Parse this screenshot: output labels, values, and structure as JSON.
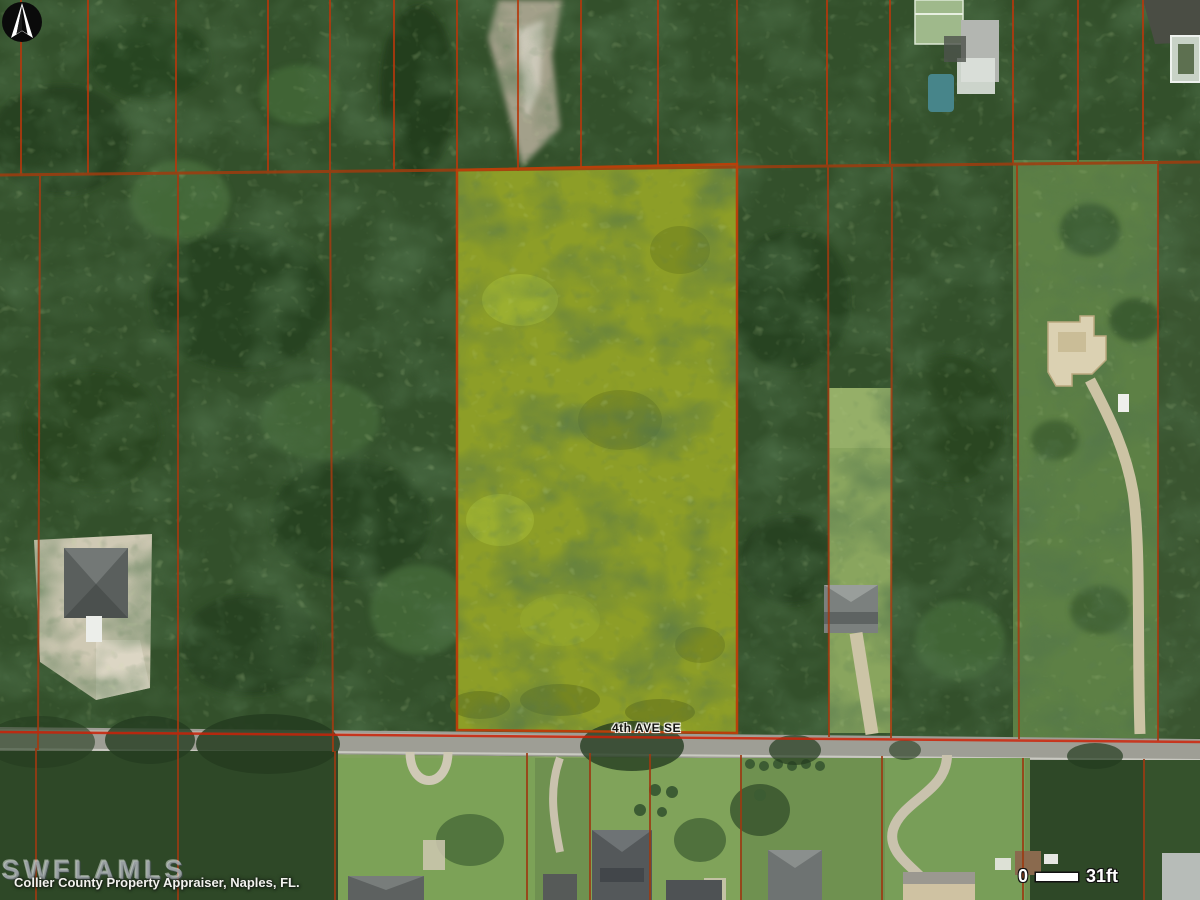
{
  "map": {
    "street_label": "4th AVE SE",
    "attribution": "Collier County Property Appraiser, Naples, FL.",
    "watermark": "SWFLAMLS",
    "scale_bar": {
      "zero": "0",
      "length": "31ft"
    },
    "colors": {
      "highlight_parcel": "#8d9e27",
      "parcel_line": "#b5380c",
      "road": "#9e9e95",
      "forest": "#33502b"
    }
  }
}
